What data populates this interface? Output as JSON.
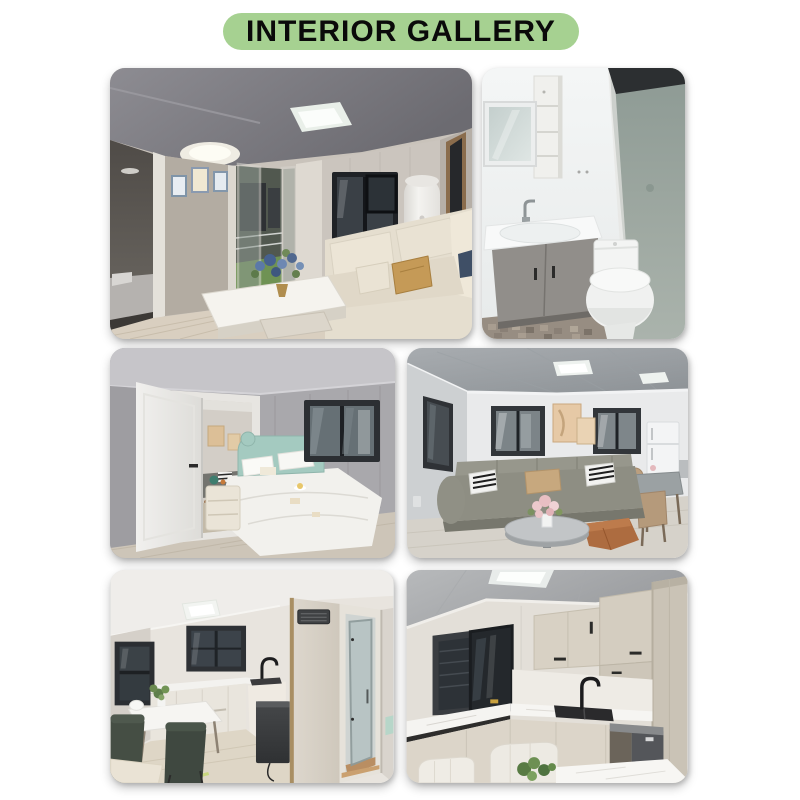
{
  "page": {
    "background_color": "#ffffff"
  },
  "header": {
    "title": "INTERIOR GALLERY",
    "pill_color": "#a6d191",
    "title_color": "#0a0a0a"
  },
  "gallery": {
    "photos": [
      {
        "name": "living-room-photo",
        "desc": "Living room with folding patio door, black framed window, water heater, beige sofa and white coffee table with blue flowers"
      },
      {
        "name": "bathroom-photo",
        "desc": "Bathroom with mirror cabinet, shelf unit, grey vanity sink, toilet and frosted glass shower screen"
      },
      {
        "name": "bedroom-photo",
        "desc": "Bedroom with mint green headboard bed, white bedding, nightstand and open white door to living room"
      },
      {
        "name": "living-dining-photo",
        "desc": "Living room with grey sofa, striped pillows, round coffee table, orange ottoman, dining set and fridge"
      },
      {
        "name": "dining-kitchen-photo",
        "desc": "Dining table with green chairs, white kitchen cabinets, black faucet and doorway to shower room"
      },
      {
        "name": "kitchen-photo",
        "desc": "Kitchen with beige cabinets, open black framed window, marble countertop, black sink and faucet"
      }
    ]
  }
}
